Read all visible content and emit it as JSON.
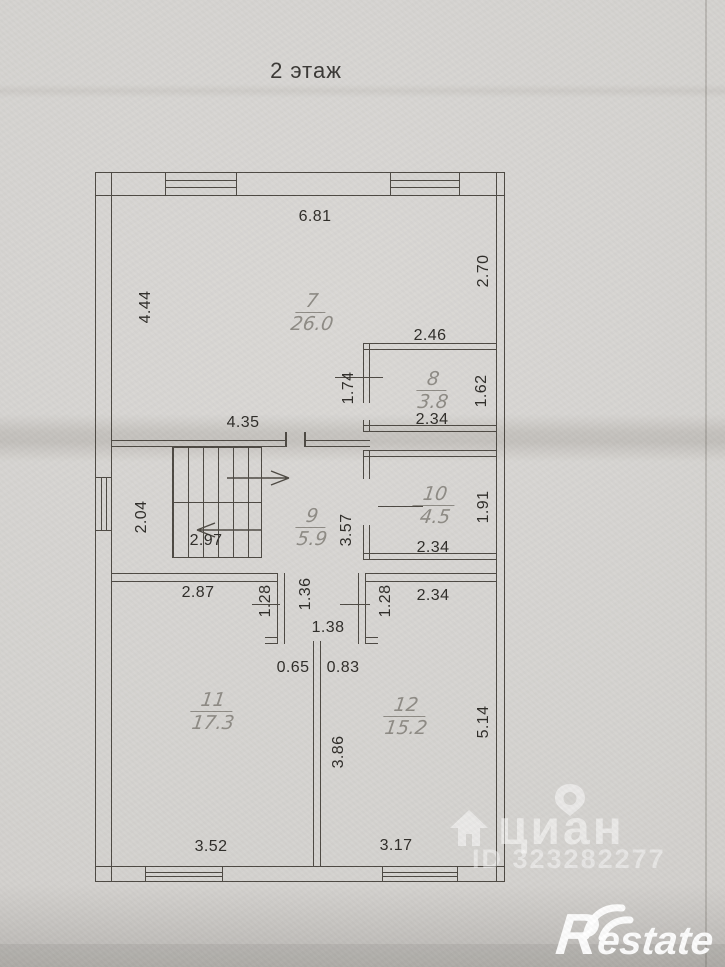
{
  "floor_title": "2 этаж",
  "plan": {
    "rooms": [
      {
        "num": "7",
        "area": "26.0"
      },
      {
        "num": "8",
        "area": "3.8"
      },
      {
        "num": "9",
        "area": "5.9"
      },
      {
        "num": "10",
        "area": "4.5"
      },
      {
        "num": "11",
        "area": "17.3"
      },
      {
        "num": "12",
        "area": "15.2"
      }
    ],
    "dimensions": {
      "room7_top": "6.81",
      "room7_left": "4.44",
      "room7_right": "2.70",
      "room8_top": "2.46",
      "room8_left": "1.74",
      "room8_right": "1.62",
      "room8_bottom": "2.34",
      "corridor_top": "4.35",
      "landing_left": "2.04",
      "stairs_width": "2.97",
      "room9_right": "3.57",
      "room10_right": "1.91",
      "room10_bottom": "2.34",
      "room11_top": "2.87",
      "hall_left": "1.28",
      "hall_height": "1.36",
      "hall_width": "1.38",
      "hall_right": "1.28",
      "room12_top": "2.34",
      "opening_left": "0.65",
      "opening_right": "0.83",
      "room11_divider": "3.86",
      "room12_right": "5.14",
      "room11_bottom": "3.52",
      "room12_bottom": "3.17"
    }
  },
  "watermarks": {
    "cian_logo": "циан",
    "cian_id": "ID 323282277",
    "restate_logo": "Restate"
  },
  "colors": {
    "paper": "#d5d3d0",
    "ink": "#4e4a44",
    "pencil_label": "#8f8c86",
    "watermark": "#ffffff"
  }
}
